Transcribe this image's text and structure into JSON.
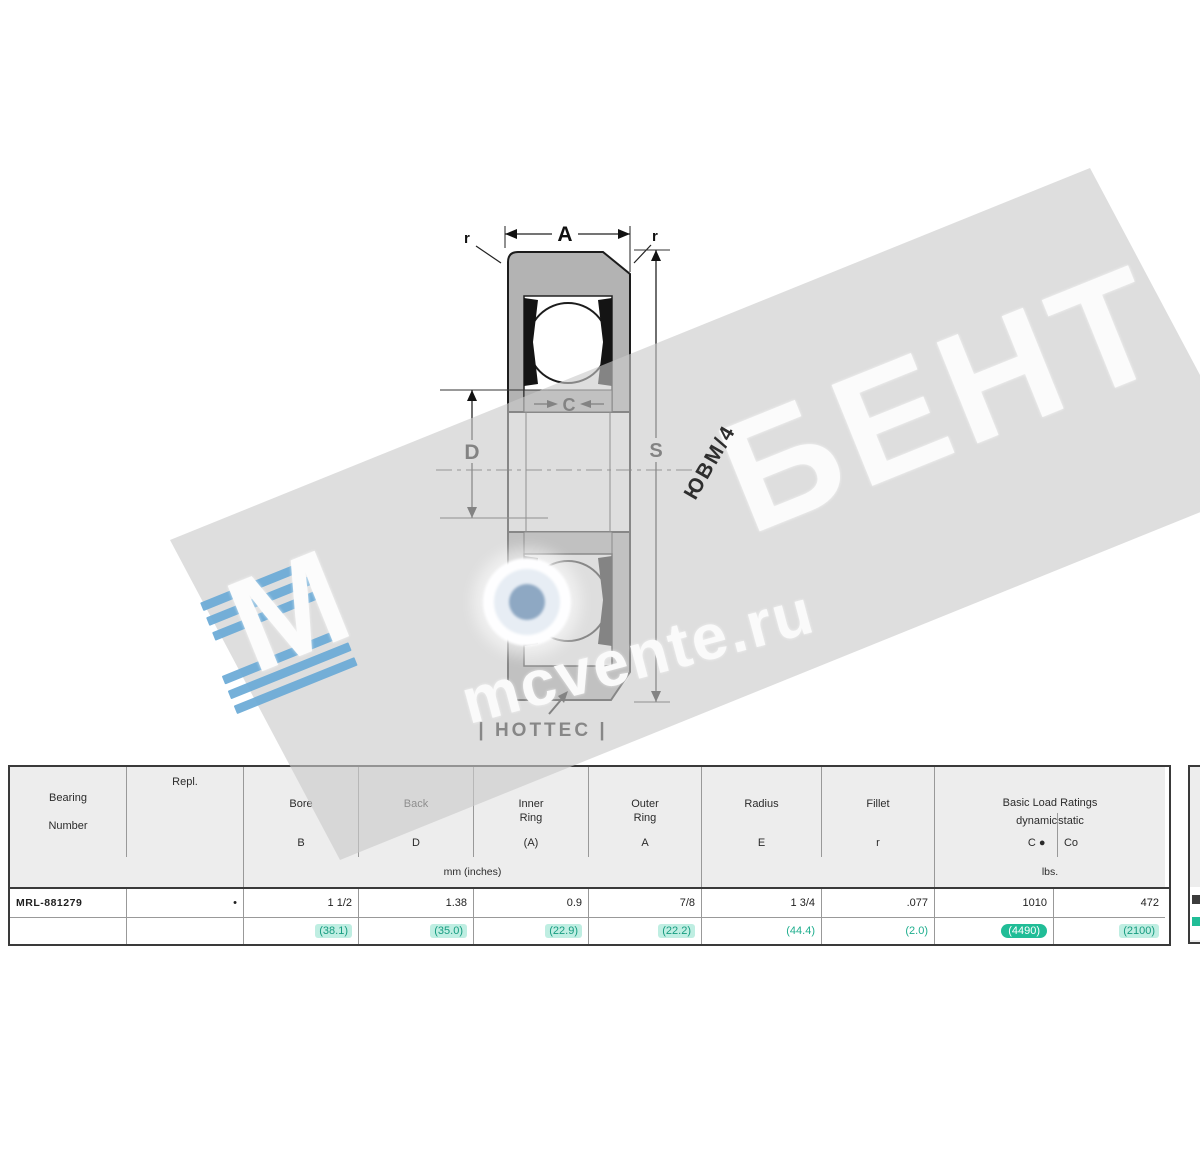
{
  "watermark": {
    "brand_m": "М",
    "brand_main": "БЕНТ",
    "site": "mcvente.ru",
    "stamp": "ЮВМ/4",
    "band_color": "#c9c9c9",
    "stripe_blue": "#69a9d6"
  },
  "drawing": {
    "labels": {
      "width": "A",
      "inner_width": "C",
      "bore": "D",
      "outside": "S",
      "fillet_left": "r",
      "fillet_right": "r"
    },
    "caption": "| HOTTEC |"
  },
  "table": {
    "columns": [
      {
        "id": "bearing_number",
        "line1": "Bearing",
        "line2": "Number",
        "symbol": ""
      },
      {
        "id": "repl",
        "line1": "Repl.",
        "line2": "",
        "symbol": ""
      },
      {
        "id": "bore",
        "line1": "Bore",
        "line2": "",
        "symbol": "B"
      },
      {
        "id": "back",
        "line1": "Back",
        "line2": "",
        "symbol": "D"
      },
      {
        "id": "inner_ring",
        "line1": "Inner",
        "line2": "Ring",
        "symbol": "(A)"
      },
      {
        "id": "outer_ring",
        "line1": "Outer",
        "line2": "Ring",
        "symbol": "A"
      },
      {
        "id": "radius",
        "line1": "Radius",
        "line2": "",
        "symbol": "E"
      },
      {
        "id": "fillet",
        "line1": "Fillet",
        "line2": "",
        "symbol": "r"
      }
    ],
    "load_group": {
      "title": "Basic Load Ratings",
      "sub_dynamic_label": "dynamic",
      "sub_dynamic_symbol": "C ●",
      "sub_static_label": "static",
      "sub_static_symbol": "Co"
    },
    "units": {
      "dimensions": "mm (inches)",
      "loads": "lbs."
    },
    "rows": [
      {
        "cells": [
          "MRL-881279",
          "•",
          "1 1/2",
          "1.38",
          "0.9",
          "7/8",
          "1 3/4",
          ".077",
          "1010",
          "472"
        ]
      },
      {
        "cells": [
          "",
          "",
          "(38.1)",
          "(35.0)",
          "(22.9)",
          "(22.2)",
          "(44.4)",
          "(2.0)",
          "(4490)",
          "(2100)"
        ]
      }
    ],
    "accent_teal": "#21bd97"
  }
}
